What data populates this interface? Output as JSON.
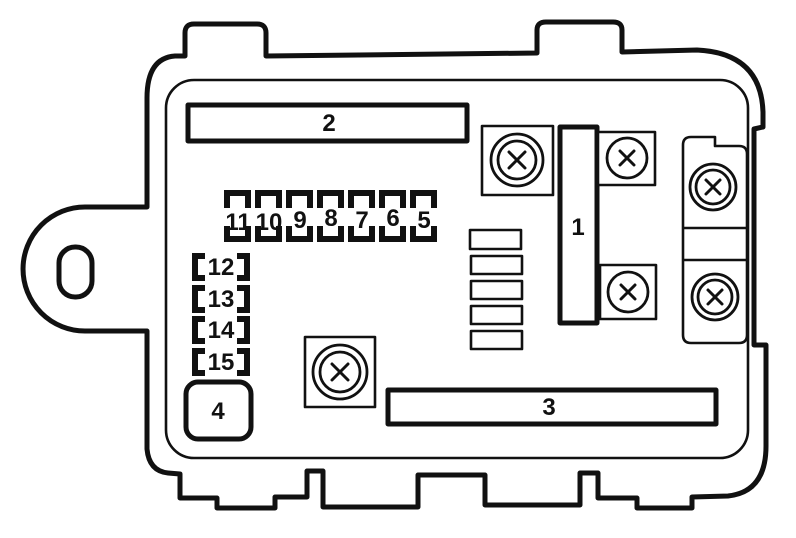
{
  "diagram": {
    "kind_label": "fuse-box-outline-diagram",
    "colors": {
      "line": "#111111",
      "background": "#ffffff"
    },
    "icons": {
      "screw_head": "circled-x",
      "mounting_hole": "oval"
    },
    "blocks": {
      "block1": "1",
      "block2": "2",
      "block3": "3",
      "block4": "4"
    },
    "fuse_row": [
      "11",
      "10",
      "9",
      "8",
      "7",
      "6",
      "5"
    ],
    "fuse_column": [
      "12",
      "13",
      "14",
      "15"
    ]
  }
}
